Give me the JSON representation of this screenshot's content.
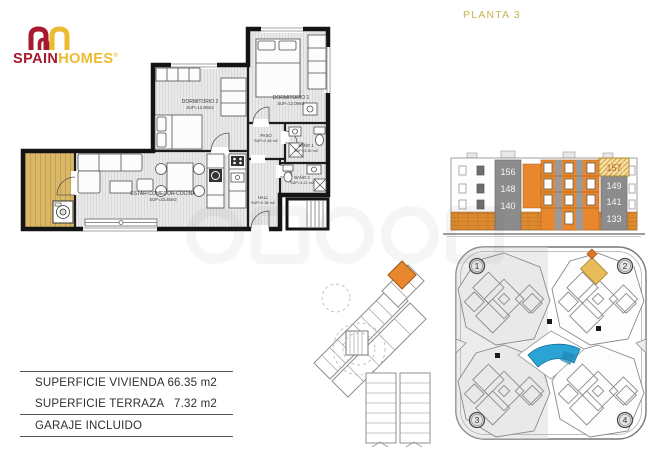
{
  "header": {
    "logo": {
      "brand_part1": "SPAIN",
      "brand_part2": "HOMES",
      "registered": "®"
    },
    "floor_label": "PLANTA 3"
  },
  "floor_plan": {
    "rooms": [
      {
        "name": "DORMITORIO 2",
        "area": "SUP=12.05m2"
      },
      {
        "name": "DORMITORIO 1",
        "area": "SUP=12.09m2"
      },
      {
        "name": "PASO",
        "area": "SUP=2.48 m2"
      },
      {
        "name": "BAÑO 1",
        "area": "SUP=3.30 m2"
      },
      {
        "name": "BAÑO 2",
        "area": "SUP=3.22 m2"
      },
      {
        "name": "HALL",
        "area": "SUP=2.38 m2"
      },
      {
        "name": "ESTAR-COMEDOR-COCINA",
        "area": "SUP=23.45m2"
      }
    ]
  },
  "elevation": {
    "left_units": [
      "156",
      "148",
      "140"
    ],
    "right_units": [
      "157",
      "149",
      "141",
      "133"
    ]
  },
  "site_plan": {
    "sectors": [
      "1",
      "2",
      "3",
      "4"
    ]
  },
  "summary": {
    "rows": [
      {
        "label": "SUPERFICIE VIVIENDA",
        "value": "66.35 m2"
      },
      {
        "label": "SUPERFICIE TERRAZA",
        "value": "7.32 m2"
      }
    ],
    "note": "GARAJE INCLUIDO"
  },
  "colors": {
    "brand_red": "#A6192E",
    "brand_yellow": "#EDBB2F",
    "floor_label_yellow": "#C9B44E",
    "accent_orange": "#E8872E",
    "highlight_tan": "#E8BC5A",
    "pool_blue": "#2BA3D4",
    "terrace_wood": "#DCBA68",
    "elevation_gray": "#8C8C8C"
  }
}
